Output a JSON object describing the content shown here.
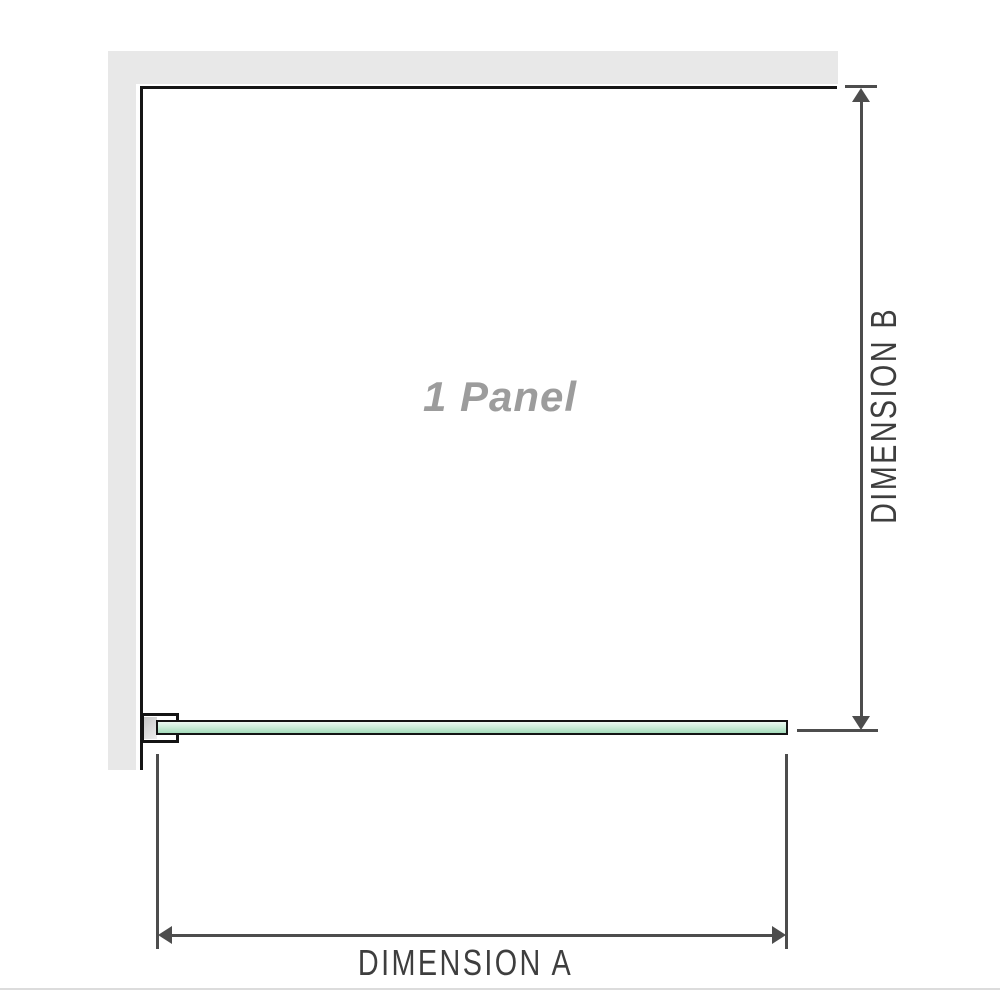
{
  "diagram": {
    "panel_label": "1 Panel",
    "dimension_a_label": "DIMENSION A",
    "dimension_b_label": "DIMENSION B"
  },
  "colors": {
    "background": "#ffffff",
    "wall_gray": "#e8e8e8",
    "frame_black": "#161616",
    "dimension_line_gray": "#4d4d4d",
    "dimension_text_gray": "#3e3e3e",
    "panel_label_gray": "#9c9c9c",
    "glass_green_top": "#edf9f2",
    "glass_green_bottom": "#a5dbbb",
    "bracket_pad_gray": "#c6c6c6",
    "bottom_rule_gray": "#dcdcdc"
  }
}
